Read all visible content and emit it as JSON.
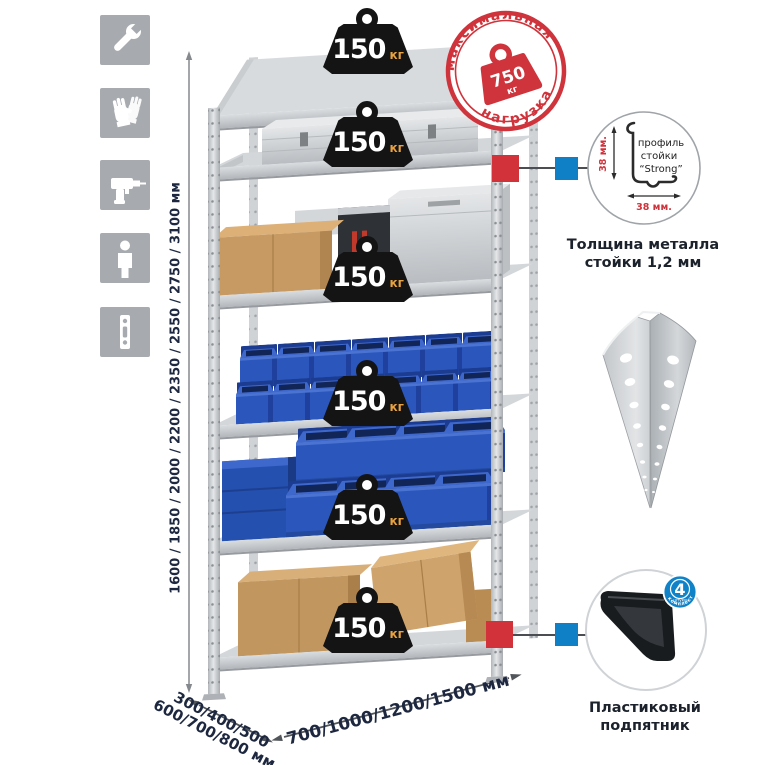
{
  "page": {
    "background": "#ffffff"
  },
  "colors": {
    "accent_red": "#d2333b",
    "accent_blue": "#1080c6",
    "bin_blue": "#2b57bd",
    "icon_gray": "#a7abaf",
    "text_dark": "#1d2840",
    "weight_black": "#141414",
    "weight_unit_orange": "#e9a23f"
  },
  "sidebar_icons": [
    {
      "name": "wrench-icon"
    },
    {
      "name": "gloves-icon"
    },
    {
      "name": "drill-icon"
    },
    {
      "name": "person-icon"
    },
    {
      "name": "post-icon"
    }
  ],
  "dimensions": {
    "height": "1600 / 1850 / 2000 / 2200 / 2350 / 2550 / 2750 / 3100 мм",
    "depth_line1": "300/400/500",
    "depth_line2": "600/700/800 мм",
    "width": "700/1000/1200/1500 мм"
  },
  "max_load": {
    "arc_top": "максимальная",
    "arc_bottom": "нагрузка",
    "value": "750",
    "unit": "кг"
  },
  "shelf_load": {
    "value": "150",
    "unit": "кг"
  },
  "profile": {
    "label_line1": "профиль",
    "label_line2": "стойки",
    "label_line3": "“Strong”",
    "dim_v": "38 мм.",
    "dim_h": "38 мм.",
    "caption_line1": "Толщина металла",
    "caption_line2": "стойки 1,2 мм"
  },
  "foot": {
    "badge_value": "4",
    "badge_sub": "штуки",
    "badge_arc": "в комплекте",
    "caption_line1": "Пластиковый",
    "caption_line2": "подпятник"
  }
}
